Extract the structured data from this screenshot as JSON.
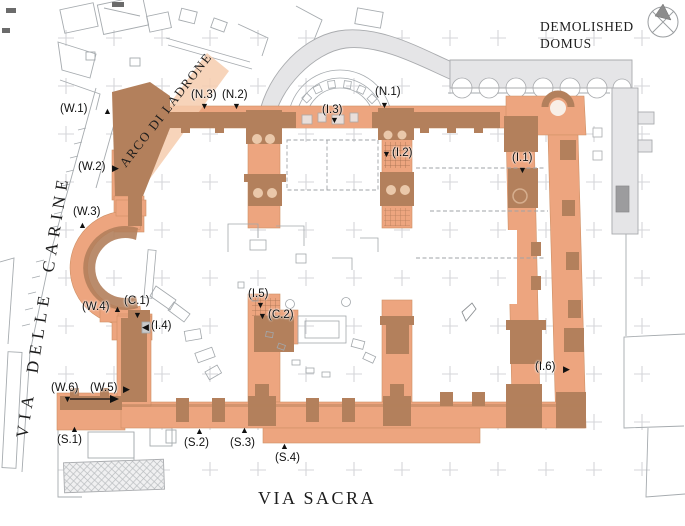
{
  "streets": {
    "via_sacra": "VIA SACRA",
    "via_delle_carine": "VIA DELLE CARINE",
    "arco_di_ladrone": "ARCO DI LADRONE"
  },
  "annotations": {
    "demolished_domus_line1": "DEMOLISHED",
    "demolished_domus_line2": "DOMUS"
  },
  "palette": {
    "wall_light": "#EDA57F",
    "wall_dark": "#B3805C",
    "arch_band": "#F6CDAE",
    "gray_fill": "#E5E5E7",
    "gray_line": "#A6ABAF",
    "grid_cross": "#D4D6D9",
    "marker_color": "#111111"
  },
  "compass": {
    "icon": "north-compass"
  },
  "marker_glyphs": {
    "up": "▲",
    "down": "▼",
    "left": "◀",
    "right": "▶"
  },
  "markers": [
    {
      "id": "W.1",
      "label": "(W.1)",
      "text": [
        60,
        103
      ],
      "tri": [
        103,
        107
      ],
      "dir": "up"
    },
    {
      "id": "W.2",
      "label": "(W.2)",
      "text": [
        78,
        161
      ],
      "tri": [
        112,
        164
      ],
      "dir": "right"
    },
    {
      "id": "W.3",
      "label": "(W.3)",
      "text": [
        73,
        206
      ],
      "tri": [
        78,
        221
      ],
      "dir": "up"
    },
    {
      "id": "N.3",
      "label": "(N.3)",
      "text": [
        191,
        89
      ],
      "tri": [
        200,
        102
      ],
      "dir": "down"
    },
    {
      "id": "N.2",
      "label": "(N.2)",
      "text": [
        222,
        89
      ],
      "tri": [
        232,
        102
      ],
      "dir": "down"
    },
    {
      "id": "I.3",
      "label": "(I.3)",
      "text": [
        322,
        104
      ],
      "tri": [
        330,
        116
      ],
      "dir": "down"
    },
    {
      "id": "N.1",
      "label": "(N.1)",
      "text": [
        375,
        86
      ],
      "tri": [
        380,
        101
      ],
      "dir": "down"
    },
    {
      "id": "I.2",
      "label": "(I.2)",
      "text": [
        392,
        147
      ],
      "tri": [
        382,
        150
      ],
      "dir": "down"
    },
    {
      "id": "I.1",
      "label": "(I.1)",
      "text": [
        512,
        152
      ],
      "tri": [
        518,
        166
      ],
      "dir": "down"
    },
    {
      "id": "W.4",
      "label": "(W.4)",
      "text": [
        82,
        301
      ],
      "tri": [
        113,
        305
      ],
      "dir": "up"
    },
    {
      "id": "C.1",
      "label": "(C.1)",
      "text": [
        124,
        295
      ],
      "tri": [
        133,
        311
      ],
      "dir": "down"
    },
    {
      "id": "I.4",
      "label": "(I.4)",
      "text": [
        151,
        320
      ],
      "tri": [
        142,
        323
      ],
      "dir": "left"
    },
    {
      "id": "I.5",
      "label": "(I.5)",
      "text": [
        248,
        288
      ],
      "tri": [
        256,
        301
      ],
      "dir": "down"
    },
    {
      "id": "C.2",
      "label": "(C.2)",
      "text": [
        268,
        309
      ],
      "tri": [
        258,
        312
      ],
      "dir": "down"
    },
    {
      "id": "I.6",
      "label": "(I.6)",
      "text": [
        535,
        361
      ],
      "tri": [
        563,
        365
      ],
      "dir": "right"
    },
    {
      "id": "W.6",
      "label": "(W.6)",
      "text": [
        51,
        382
      ],
      "tri": [
        63,
        395
      ],
      "dir": "down"
    },
    {
      "id": "W.5",
      "label": "(W.5)",
      "text": [
        90,
        382
      ],
      "tri": [
        123,
        385
      ],
      "dir": "right"
    },
    {
      "id": "S.1",
      "label": "(S.1)",
      "text": [
        57,
        434
      ],
      "tri": [
        70,
        425
      ],
      "dir": "up"
    },
    {
      "id": "S.2",
      "label": "(S.2)",
      "text": [
        184,
        437
      ],
      "tri": [
        195,
        427
      ],
      "dir": "up"
    },
    {
      "id": "S.3",
      "label": "(S.3)",
      "text": [
        230,
        437
      ],
      "tri": [
        240,
        426
      ],
      "dir": "up"
    },
    {
      "id": "S.4",
      "label": "(S.4)",
      "text": [
        275,
        452
      ],
      "tri": [
        280,
        442
      ],
      "dir": "up"
    }
  ]
}
